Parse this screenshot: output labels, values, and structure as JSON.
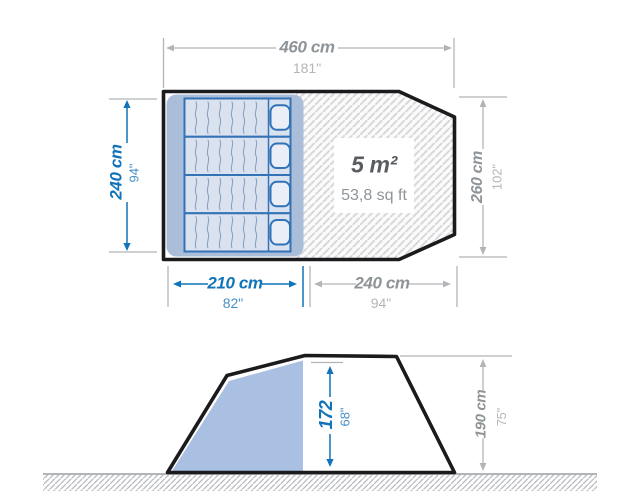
{
  "meta": {
    "title": "Tent dimensions diagram"
  },
  "colors": {
    "accent_blue": "#1173b9",
    "dimension_gray": "#b2b5b8",
    "outline_black": "#1b1b1d",
    "sleeping_area_fill": "#aabdd9",
    "elevation_cabin_fill": "#a9c0e2"
  },
  "floor_plan": {
    "total_width": {
      "metric": "460 cm",
      "imperial": "181\""
    },
    "bedroom_depth": {
      "metric": "240 cm",
      "imperial": "94\""
    },
    "living_depth": {
      "metric": "260 cm",
      "imperial": "102\""
    },
    "bedroom_width": {
      "metric": "210 cm",
      "imperial": "82\""
    },
    "living_width": {
      "metric": "240 cm",
      "imperial": "94\""
    },
    "living_area": {
      "metric": "5 m²",
      "imperial": "53,8 sq ft"
    },
    "bed_count": 4
  },
  "elevation": {
    "interior_height": {
      "metric": "172",
      "imperial": "68\""
    },
    "peak_height": {
      "metric": "190 cm",
      "imperial": "75\""
    }
  }
}
